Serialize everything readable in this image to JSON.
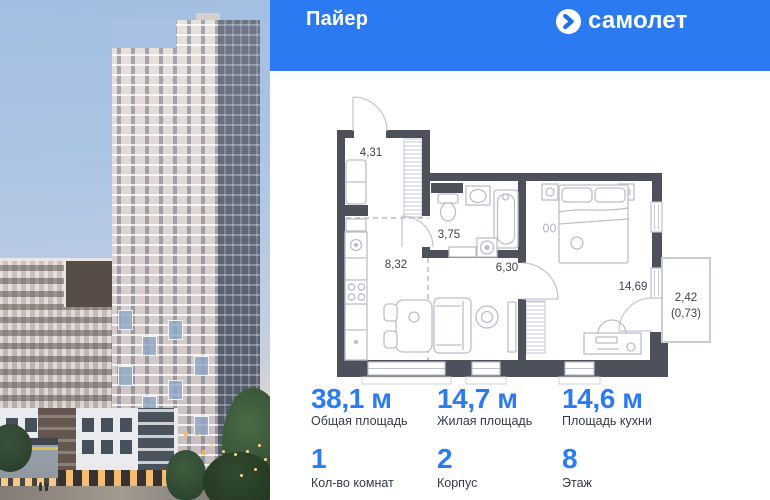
{
  "header": {
    "project_name": "Пайер",
    "brand_name": "самолет"
  },
  "colors": {
    "header_bg": "#2b7af2",
    "accent_blue": "#2b7bf1",
    "plan_wall": "#4c515c"
  },
  "plan": {
    "rooms": [
      {
        "id": "hallway",
        "area": "4,31"
      },
      {
        "id": "bathroom",
        "area": "3,75"
      },
      {
        "id": "kitchen-zone",
        "area": "8,32"
      },
      {
        "id": "living-zone",
        "area": "6,30"
      },
      {
        "id": "bedroom",
        "area": "14,69"
      },
      {
        "id": "balcony",
        "area": "2,42",
        "area_coef": "(0,73)"
      }
    ]
  },
  "stats": {
    "primary": [
      {
        "value": "38,1 м",
        "label": "Общая площадь"
      },
      {
        "value": "14,7 м",
        "label": "Жилая площадь"
      },
      {
        "value": "14,6 м",
        "label": "Площадь кухни"
      }
    ],
    "secondary": [
      {
        "value": "1",
        "label": "Кол-во комнат"
      },
      {
        "value": "2",
        "label": "Корпус"
      },
      {
        "value": "8",
        "label": "Этаж"
      }
    ]
  }
}
